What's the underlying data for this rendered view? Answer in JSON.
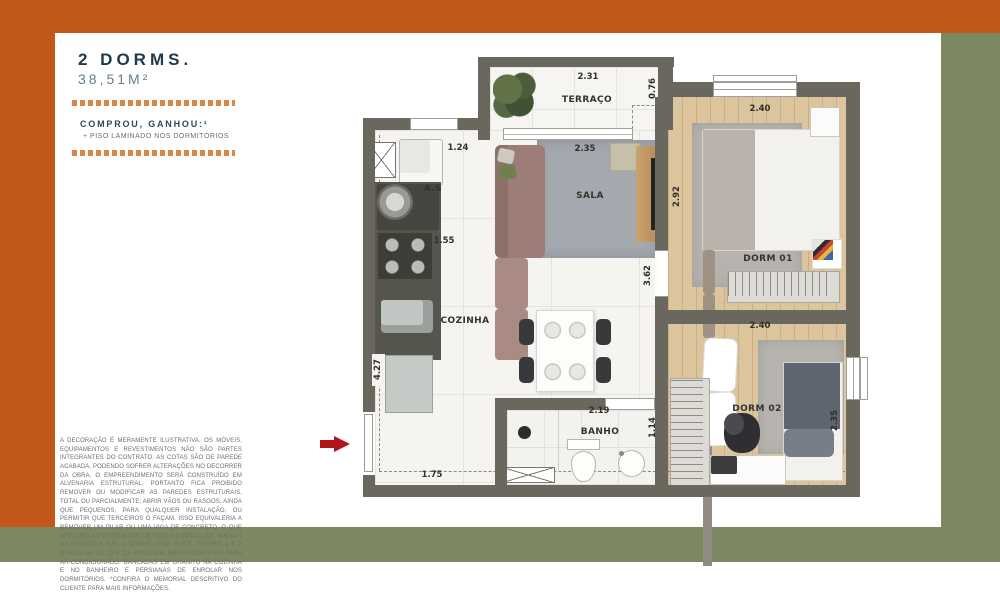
{
  "colors": {
    "accent_orange": "#c3581b",
    "olive_green": "#7b8862",
    "title_navy": "#21394a",
    "area_teal": "#64808f",
    "promo_navy": "#2b4a5a",
    "arrow_red": "#b3151d",
    "wall_gray": "#69675e",
    "wood_floor": "#dcc59c"
  },
  "panel": {
    "title": "2 DORMS.",
    "area": "38,51M²",
    "promo_heading": "COMPROU, GANHOU:¹",
    "promo_bullet": "+",
    "promo_item": "PISO LAMINADO NOS DORMITÓRIOS",
    "disclaimer": "A DECORAÇÃO É MERAMENTE ILUSTRATIVA. OS MÓVEIS, EQUIPAMENTOS E REVESTIMENTOS NÃO SÃO PARTES INTEGRANTES DO CONTRATO. AS COTAS SÃO DE PAREDE ACABADA, PODENDO SOFRER ALTERAÇÕES NO DECORRER DA OBRA. O EMPREENDIMENTO SERÁ CONSTRUÍDO EM ALVENARIA ESTRUTURAL, PORTANTO FICA PROIBIDO REMOVER OU MODIFICAR AS PAREDES ESTRUTURAIS, TOTAL OU PARCIALMENTE; ABRIR VÃOS OU RASGOS, AINDA QUE PEQUENOS, PARA QUALQUER INSTALAÇÃO, OU PERMITIR QUE TERCEIROS O FAÇAM. ISSO EQUIVALERIA A REMOVER UM PILAR OU UMA VIGA DE CONCRETO, O QUE AFETARIA A ESTABILIDADE DE TODA A EDIFICAÇÃO. APENAS AS UNIDADES R2V, 2 DORMS. COM SUÍTE, TORRES 1 E 2 (FINAIS 04, 05, 12 E 13) POSSUEM INFRAESTRUTURA PARA AR-CONDICIONADO. BANCADAS EM GRANITO NA COZINHA E NO BANHEIRO E PERSIANAS DE ENROLAR NOS DORMITÓRIOS. *CONFIRA O MEMORIAL DESCRITIVO DO CLIENTE PARA MAIS INFORMAÇÕES."
  },
  "floor_plan": {
    "terraco": {
      "label": "TERRAÇO",
      "width": "2.31",
      "depth": "0.76"
    },
    "sala": {
      "label": "SALA",
      "width": "2.35",
      "depth": "2.92"
    },
    "hall": {
      "depth": "3.62"
    },
    "area_servico": {
      "label": "A.S",
      "width": "1.24",
      "counter_width": "1.55"
    },
    "cozinha": {
      "label": "COZINHA",
      "depth": "4.27",
      "entry_width": "1.75"
    },
    "banho": {
      "label": "BANHO",
      "width": "2.19",
      "depth": "1.14"
    },
    "dorm1": {
      "label": "DORM 01",
      "width": "2.40"
    },
    "dorm2": {
      "label": "DORM 02",
      "width": "2.40",
      "depth": "2.35"
    }
  }
}
